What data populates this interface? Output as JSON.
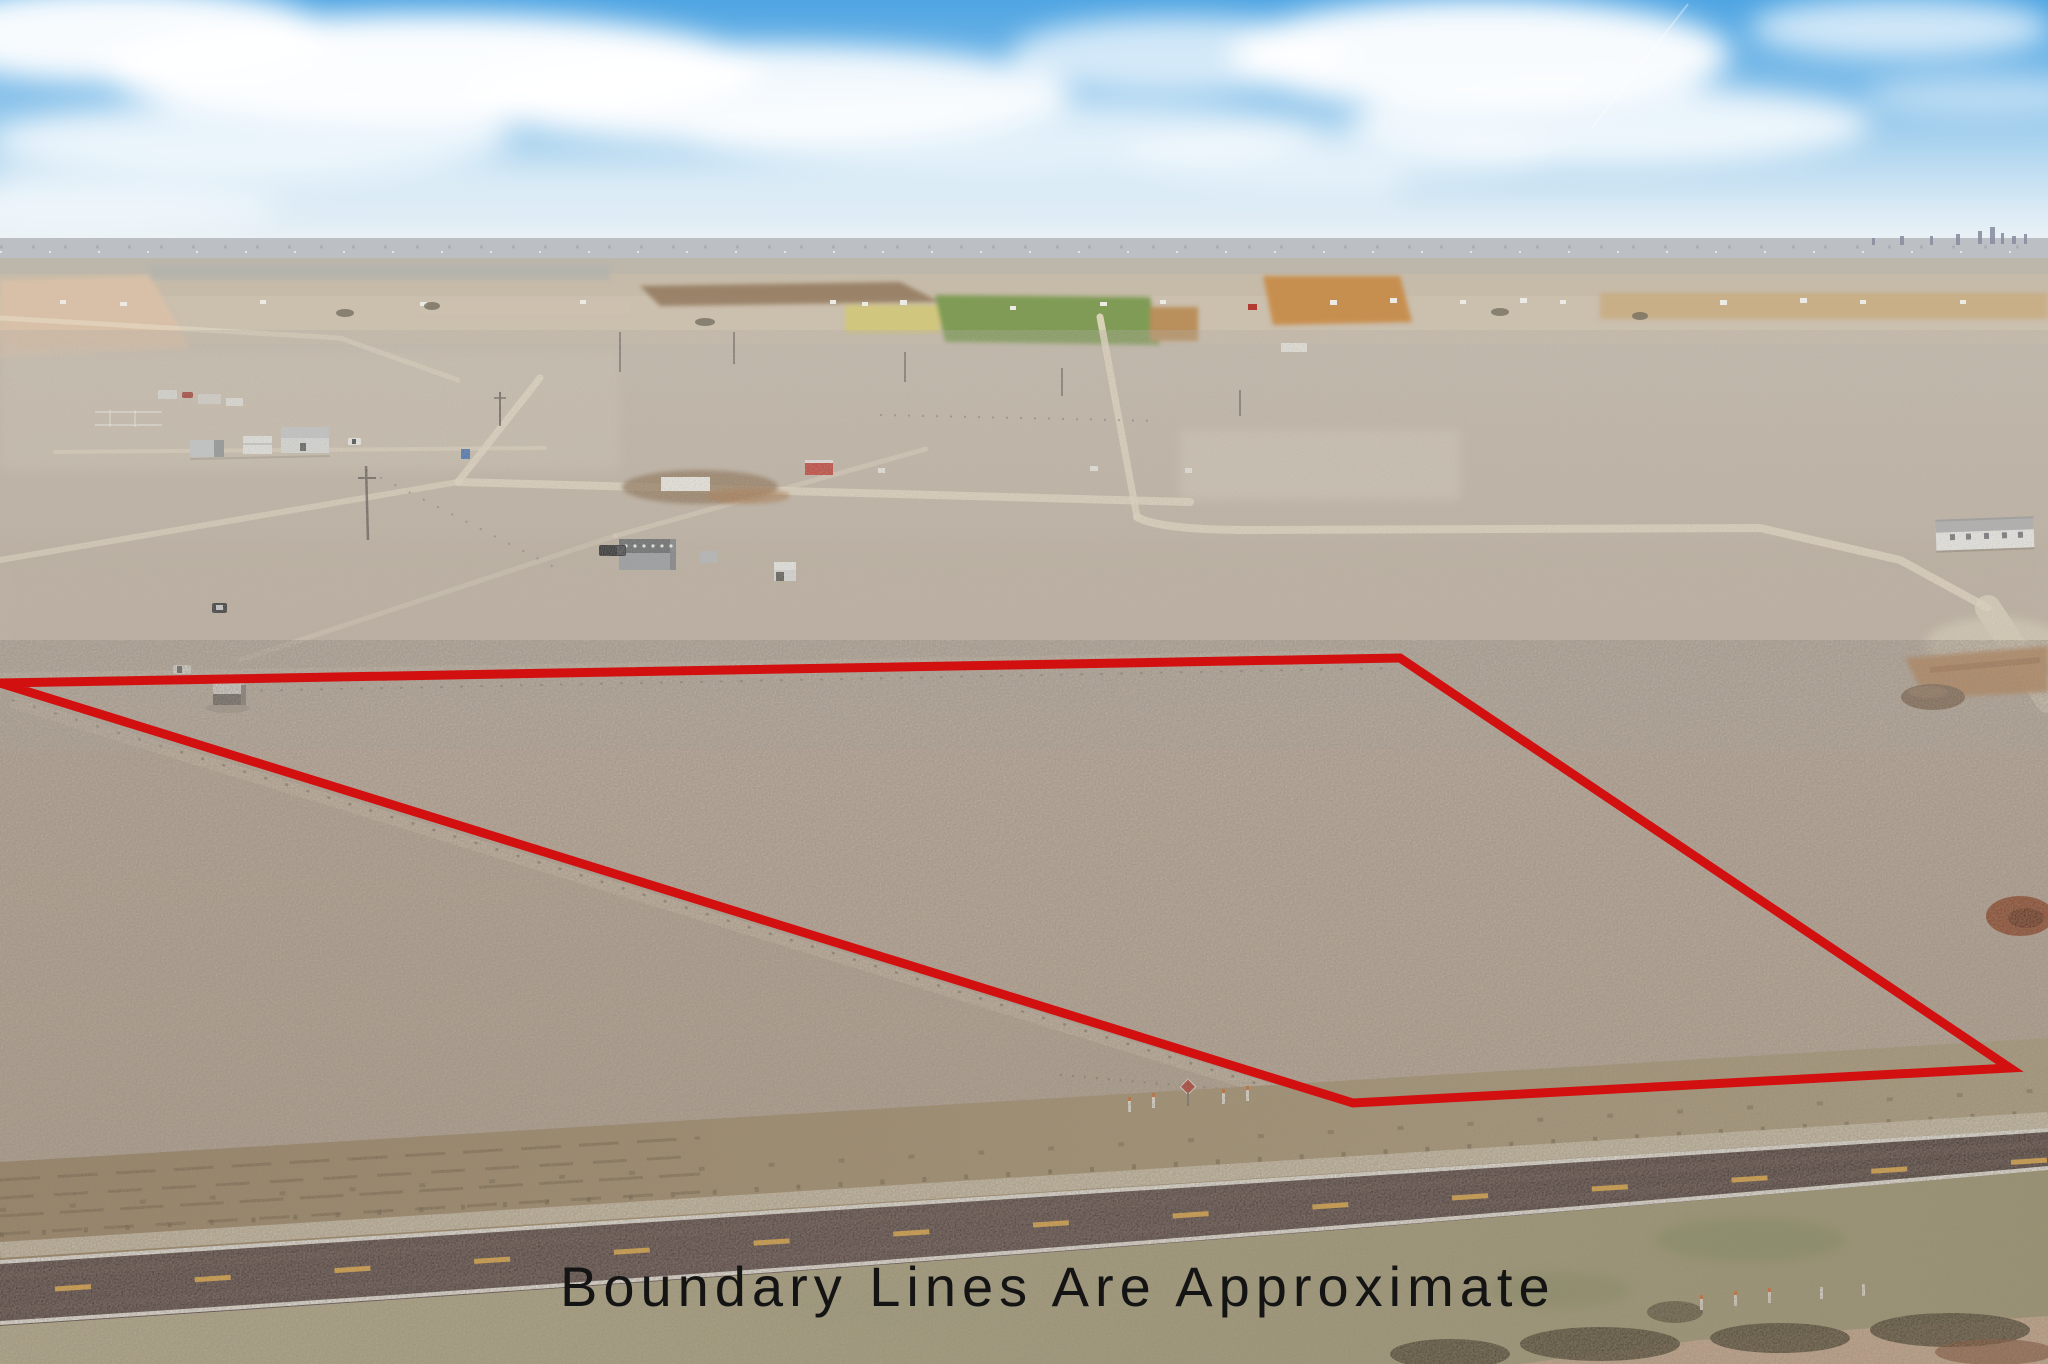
{
  "meta": {
    "description": "Aerial drone photograph of flat high-plains farmland parcel for sale; a red polygon outlines the approximate property boundary above a two-lane highway; black disclaimer caption across the bottom",
    "horizon": "distant small-city skyline at far right of horizon"
  },
  "caption": {
    "text": "Boundary Lines Are Approximate",
    "color": "#141414"
  },
  "boundary": {
    "color": "#d21010",
    "stroke_width": "9",
    "points": "0,683 1400,658 2010,1068 1353,1103"
  },
  "palette": {
    "sky_top": "#4fa5e3",
    "sky_mid": "#a8d0ee",
    "sky_horizon": "#e9f1f6",
    "cloud": "#ffffff",
    "distant_band_gray": "#bcbfc4",
    "field_tan": "#c6bba9",
    "field_green": "#7f9b55",
    "field_yellow_green": "#d2c678",
    "field_orange": "#c78f50",
    "plowed_pink": "#d8c0a8",
    "ground_mid": "#c2b6a6",
    "ground_foreground": "#b5a897",
    "dirt_road": "#e7dcc6",
    "disturbed_dirt_brown": "#8a6c4e",
    "dirt_orange": "#bf7a3e",
    "rust_pile": "#8f4526",
    "asphalt": "#4e3d3a",
    "road_edge_line": "#efeee6",
    "road_center_line": "#dfa43b",
    "verge_brown": "#98815f",
    "verge_grass": "#ad9f7e",
    "brush_dark": "#453d26",
    "barn_roof": "#5f6368",
    "barn_wall": "#969ba1",
    "red_trailer": "#c23a30",
    "mobile_home_wall": "#f0f0ed"
  },
  "objects": [
    {
      "name": "sky",
      "label": "blue sky with streaky white clouds"
    },
    {
      "name": "city-skyline",
      "label": "tiny city skyline on right horizon"
    },
    {
      "name": "distant-fields",
      "label": "patchwork of tan, green, orange and pink fields"
    },
    {
      "name": "farmstead-left",
      "label": "farmstead with white buildings, trailers and pens"
    },
    {
      "name": "metal-barn",
      "label": "gray metal barn with dark roof and black pickup"
    },
    {
      "name": "concrete-slab",
      "label": "white slab on disturbed brown dirt"
    },
    {
      "name": "red-trailer",
      "label": "small bright red trailer"
    },
    {
      "name": "portable-toilet",
      "label": "blue portable toilet"
    },
    {
      "name": "parcel-shed",
      "label": "small shed with white roof near left boundary"
    },
    {
      "name": "white-pickup",
      "label": "white pickup truck near shed"
    },
    {
      "name": "mobile-home",
      "label": "white manufactured home at right"
    },
    {
      "name": "dirt-mound",
      "label": "orange cut dirt and brown spoil mound at right"
    },
    {
      "name": "rust-pile",
      "label": "rust-colored pile near right edge"
    },
    {
      "name": "dirt-roads",
      "label": "pale caliche section roads"
    },
    {
      "name": "highway",
      "label": "two-lane asphalt highway with yellow dashed center line"
    },
    {
      "name": "grass-verge",
      "label": "brown/olive grass right-of-way"
    },
    {
      "name": "roadside-markers",
      "label": "small red diamond sign and white posts with orange tops"
    },
    {
      "name": "brush",
      "label": "dark brush along bottom right"
    },
    {
      "name": "boundary-polygon",
      "label": "red approximate boundary outline"
    },
    {
      "name": "caption",
      "label": "disclaimer text"
    }
  ]
}
